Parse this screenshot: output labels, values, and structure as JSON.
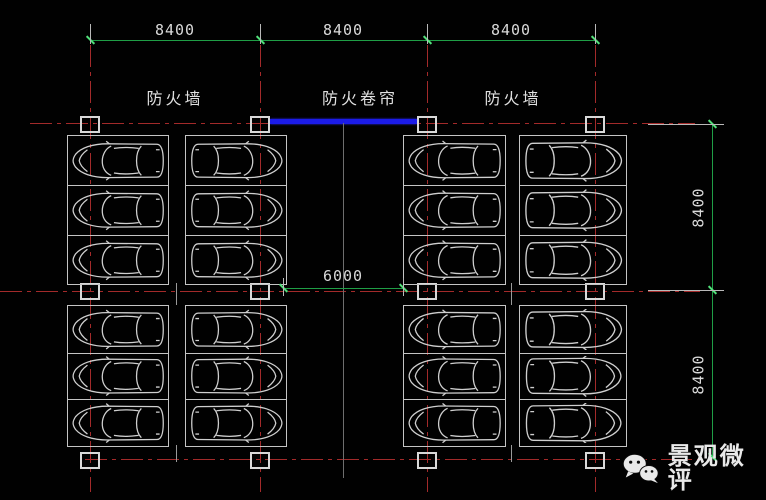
{
  "labels": {
    "fire_wall_left": "防火墙",
    "fire_shutter": "防火卷帘",
    "fire_wall_right": "防火墙"
  },
  "dimensions": {
    "top": [
      "8400",
      "8400",
      "8400"
    ],
    "right": [
      "8400",
      "8400"
    ],
    "aisle": "6000"
  },
  "watermark": {
    "icon": "wechat-icon",
    "text": "景观微评"
  },
  "colors": {
    "background": "#010101",
    "grid_red": "#a32a2a",
    "dimension_green": "#1f9e46",
    "outline_white": "#c4c4c4",
    "shutter_blue": "#1b1be8",
    "text": "#d9d9d9"
  },
  "parking": {
    "blocks": 4,
    "rows_per_block": 3,
    "cols_per_block": 2,
    "total_stalls": 24
  }
}
